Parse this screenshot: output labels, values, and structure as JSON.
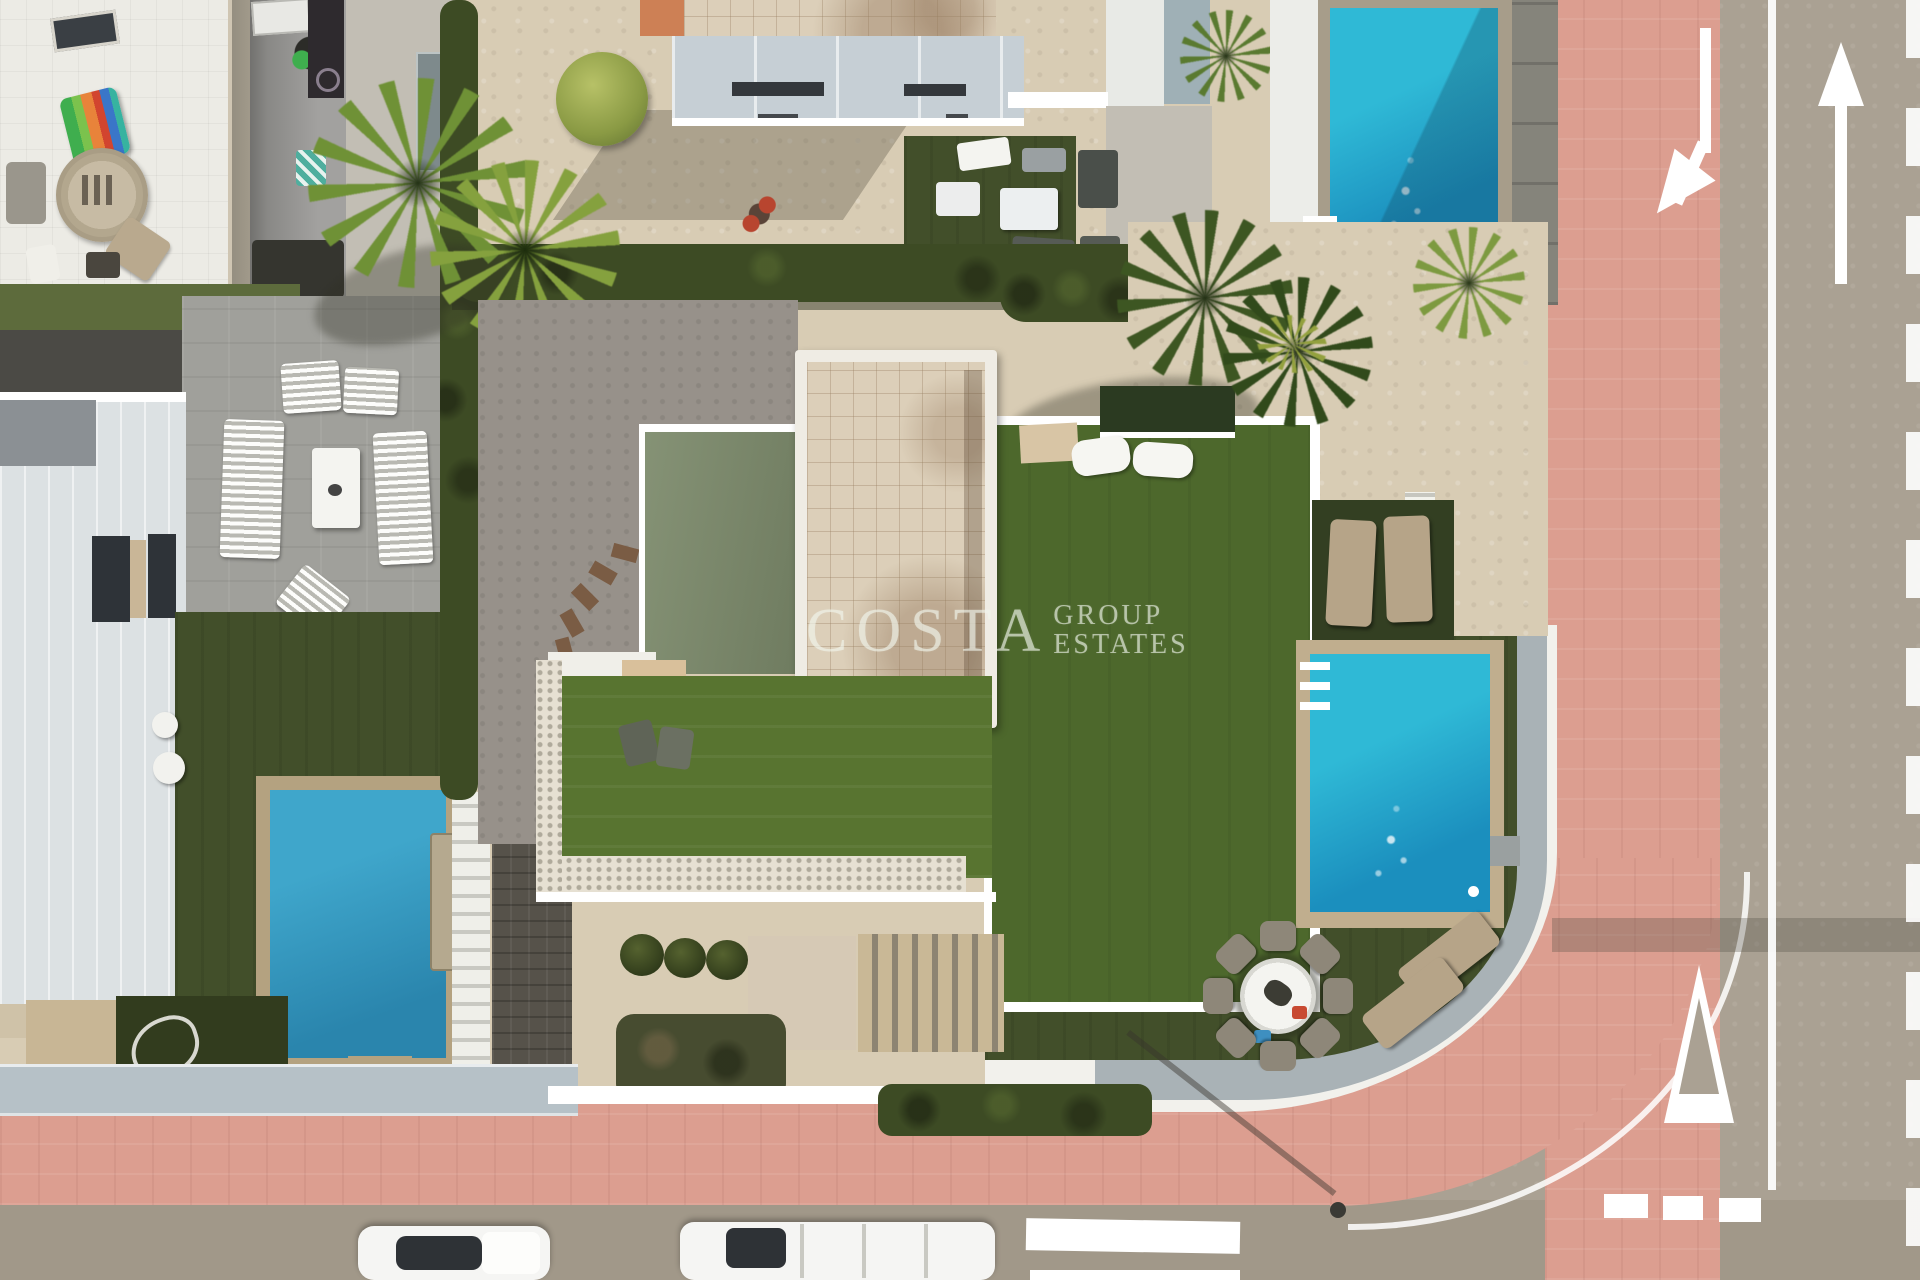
{
  "watermark": {
    "primary": "COSTA",
    "secondary_top": "GROUP",
    "secondary_bottom": "ESTATES"
  },
  "colors": {
    "sand": "#d8ccb4",
    "gravel": "#97918a",
    "patio": "#a0a09b",
    "pavingLight": "#c2beb4",
    "turfDark": "#424f2a",
    "turfBright": "#587430",
    "roofTurf": "#4d682c",
    "sageRoof": "#7c8a6b",
    "tileCream": "#dccfb9",
    "poolWater": "#2fb9d6",
    "poolDeep": "#1b8fbe",
    "poolBorder": "#c0ae8e",
    "pinkPaver": "#dc9e90",
    "roadAsphalt": "#aaa193",
    "roadBottom": "#a19889",
    "wallWhite": "#f2f1ec",
    "wallGray": "#a9b2b6",
    "hedge": "#3d4b24",
    "palm": "#6f9136",
    "palmDark": "#3d5622",
    "building": "#dce1e3",
    "buildingBlue": "#c6cfd5",
    "carWhite": "#f5f5f3",
    "watermark": "rgba(240,246,236,0.62)"
  },
  "scene": {
    "type": "aerial-drone-photo",
    "elements": [
      "residential-villas",
      "three-swimming-pools",
      "artificial-turf-gardens",
      "palm-trees",
      "pink-paver-sidewalk",
      "asphalt-roads",
      "parked-white-cars",
      "outdoor-dining-set",
      "sun-loungers",
      "tiled-roof-tower"
    ]
  },
  "road_markings": [
    "left-turn-arrow",
    "straight-arrow",
    "solid-center-line",
    "dashed-edge-line",
    "yield-triangle",
    "dashed-stop-line",
    "crosswalk-bars",
    "corner-edge-arc"
  ]
}
